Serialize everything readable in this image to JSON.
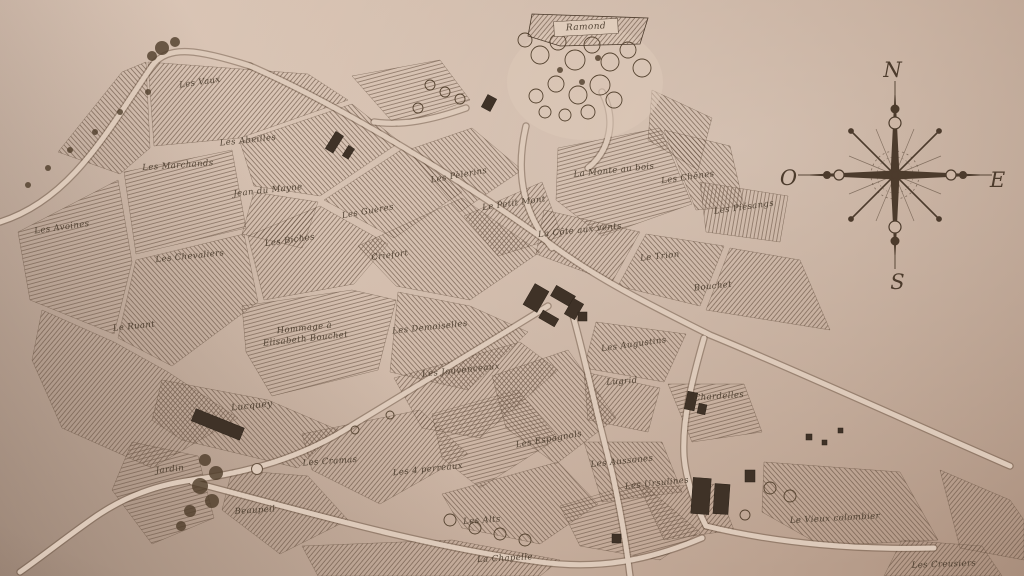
{
  "map": {
    "banner": "Ramond",
    "compass": {
      "north": "N",
      "east": "E",
      "south": "S",
      "west": "O"
    },
    "colors": {
      "ink": "#4c3b2c",
      "hatch": "#6b5545",
      "road": "#ddcaba",
      "road_edge": "#65503e",
      "paper": "#cdb6a5"
    },
    "labels": [
      {
        "text": "Ramond",
        "x": 586,
        "y": 28,
        "rot": -3,
        "fs": 9
      },
      {
        "text": "Les Vaux",
        "x": 200,
        "y": 83,
        "rot": -8,
        "fs": 8.5
      },
      {
        "text": "Les Abeilles",
        "x": 248,
        "y": 141,
        "rot": -6,
        "fs": 8.5
      },
      {
        "text": "Les Marchands",
        "x": 178,
        "y": 166,
        "rot": -4,
        "fs": 8.5
      },
      {
        "text": "Jean du Mayne",
        "x": 268,
        "y": 191,
        "rot": -6,
        "fs": 8.5
      },
      {
        "text": "Les Avoines",
        "x": 62,
        "y": 228,
        "rot": -8,
        "fs": 8.5
      },
      {
        "text": "Les Guères",
        "x": 368,
        "y": 212,
        "rot": -10,
        "fs": 8.5
      },
      {
        "text": "Les Biches",
        "x": 290,
        "y": 241,
        "rot": -8,
        "fs": 8.5
      },
      {
        "text": "Les Chevaliers",
        "x": 190,
        "y": 257,
        "rot": -6,
        "fs": 8.5
      },
      {
        "text": "Criefort",
        "x": 390,
        "y": 256,
        "rot": -8,
        "fs": 8.5
      },
      {
        "text": "Les Pèlerins",
        "x": 459,
        "y": 176,
        "rot": -10,
        "fs": 8.5
      },
      {
        "text": "Le Petit Mont",
        "x": 514,
        "y": 204,
        "rot": -8,
        "fs": 8.5
      },
      {
        "text": "La Monte au bois",
        "x": 614,
        "y": 171,
        "rot": -6,
        "fs": 8.5
      },
      {
        "text": "Les Chênes",
        "x": 688,
        "y": 178,
        "rot": -8,
        "fs": 8.5
      },
      {
        "text": "Les Piésangs",
        "x": 744,
        "y": 208,
        "rot": -8,
        "fs": 8.5
      },
      {
        "text": "La Côte aux vents",
        "x": 580,
        "y": 231,
        "rot": -6,
        "fs": 8.5
      },
      {
        "text": "Le Trion",
        "x": 660,
        "y": 257,
        "rot": -6,
        "fs": 8.5
      },
      {
        "text": "Bouchet",
        "x": 713,
        "y": 287,
        "rot": -6,
        "fs": 8.5
      },
      {
        "text": "Le Ruant",
        "x": 134,
        "y": 327,
        "rot": -6,
        "fs": 8.5
      },
      {
        "text": "Hommage à\nElisabeth Bouchet",
        "x": 305,
        "y": 334,
        "rot": -6,
        "fs": 8.5
      },
      {
        "text": "Les Demoiselles",
        "x": 430,
        "y": 328,
        "rot": -6,
        "fs": 8.5
      },
      {
        "text": "Les Jouvenceaux",
        "x": 461,
        "y": 371,
        "rot": -6,
        "fs": 8.5
      },
      {
        "text": "Les Augustins",
        "x": 634,
        "y": 345,
        "rot": -8,
        "fs": 8.5
      },
      {
        "text": "Lugrid",
        "x": 622,
        "y": 382,
        "rot": -4,
        "fs": 8.5
      },
      {
        "text": "Chardelles",
        "x": 719,
        "y": 397,
        "rot": -4,
        "fs": 8.5
      },
      {
        "text": "Lucquey",
        "x": 252,
        "y": 407,
        "rot": -6,
        "fs": 9
      },
      {
        "text": "Les Cramas",
        "x": 330,
        "y": 462,
        "rot": -4,
        "fs": 8.5
      },
      {
        "text": "Jardin",
        "x": 170,
        "y": 470,
        "rot": -6,
        "fs": 8.5
      },
      {
        "text": "Beaupeil",
        "x": 255,
        "y": 511,
        "rot": -4,
        "fs": 8.5
      },
      {
        "text": "Les 4 perreaux",
        "x": 428,
        "y": 470,
        "rot": -6,
        "fs": 8.5
      },
      {
        "text": "Les Espagnols",
        "x": 549,
        "y": 440,
        "rot": -10,
        "fs": 8.5
      },
      {
        "text": "Les Aussones",
        "x": 622,
        "y": 462,
        "rot": -6,
        "fs": 8.5
      },
      {
        "text": "Les Ursulines",
        "x": 657,
        "y": 484,
        "rot": -6,
        "fs": 8.5
      },
      {
        "text": "Les Alts",
        "x": 482,
        "y": 521,
        "rot": -4,
        "fs": 8.5
      },
      {
        "text": "La Chapelle",
        "x": 505,
        "y": 559,
        "rot": -3,
        "fs": 8.5
      },
      {
        "text": "Le Vieux colombier",
        "x": 835,
        "y": 519,
        "rot": -3,
        "fs": 8.5
      },
      {
        "text": "Les Creusiers",
        "x": 944,
        "y": 565,
        "rot": -2,
        "fs": 8.5
      }
    ]
  }
}
